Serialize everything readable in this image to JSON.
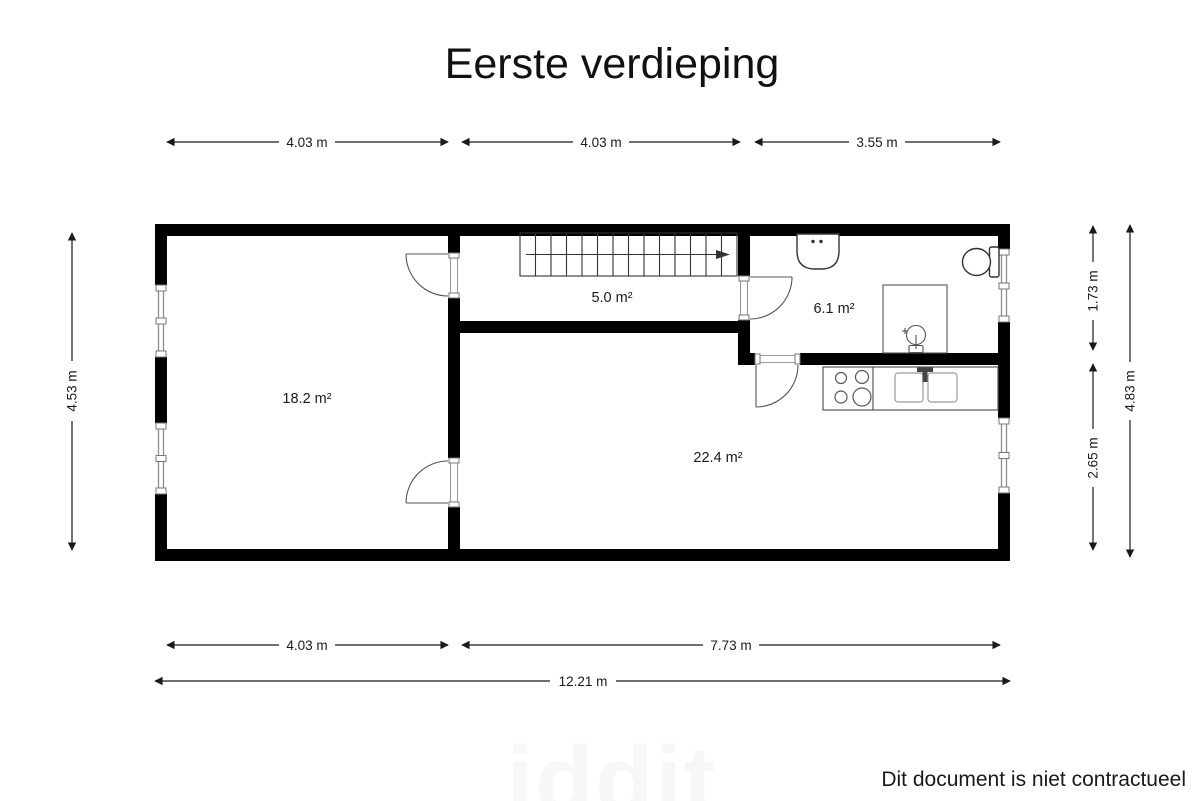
{
  "title": "Eerste verdieping",
  "plan": {
    "rooms": {
      "left_room_area": "18.2 m²",
      "hallway_area": "5.0 m²",
      "bathroom_area": "6.1 m²",
      "living_kitchen_area": "22.4 m²"
    },
    "dimensions": {
      "top": [
        "4.03 m",
        "4.03 m",
        "3.55 m"
      ],
      "left": "4.53 m",
      "right_inner": [
        "1.73 m",
        "2.65 m"
      ],
      "right_outer": "4.83 m",
      "bottom": [
        "4.03 m",
        "7.73 m"
      ],
      "bottom_total": "12.21 m"
    }
  },
  "watermark": "iddit",
  "footer": {
    "disclaimer": "Dit document is niet contractueel"
  },
  "colors": {
    "wall": "#000000",
    "thin_line": "#555555",
    "text": "#1a1a1a"
  }
}
